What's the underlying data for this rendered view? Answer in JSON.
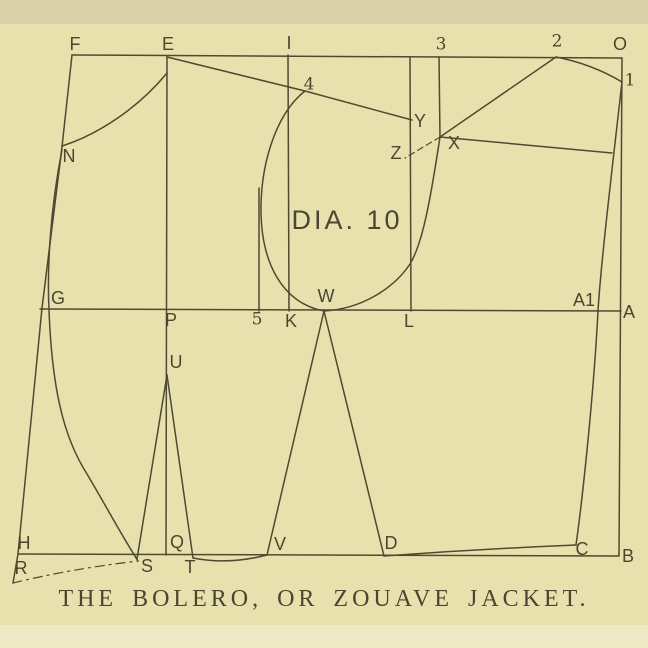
{
  "colors": {
    "paper": "#e9e1ad",
    "band_top": "#d8d1a9",
    "band_bottom": "#efe9c6",
    "ink": "#4e4932",
    "text": "#4a4631"
  },
  "caption": {
    "text": "THE BOLERO, OR ZOUAVE JACKET."
  },
  "diagram": {
    "title": "DIA. 10",
    "title_pos": {
      "x": 347,
      "y": 222
    },
    "points": [
      {
        "label": "F",
        "x": 75,
        "y": 45,
        "serif": false
      },
      {
        "label": "E",
        "x": 168,
        "y": 45,
        "serif": false
      },
      {
        "label": "I",
        "x": 289,
        "y": 44,
        "serif": false
      },
      {
        "label": "3",
        "x": 441,
        "y": 45,
        "serif": true
      },
      {
        "label": "2",
        "x": 557,
        "y": 42,
        "serif": true
      },
      {
        "label": "O",
        "x": 620,
        "y": 45,
        "serif": false
      },
      {
        "label": "1",
        "x": 630,
        "y": 81,
        "serif": true
      },
      {
        "label": "4",
        "x": 309,
        "y": 85,
        "serif": true
      },
      {
        "label": "N",
        "x": 69,
        "y": 157,
        "serif": false
      },
      {
        "label": "Y",
        "x": 420,
        "y": 122,
        "serif": false
      },
      {
        "label": "Z",
        "x": 396,
        "y": 154,
        "serif": false
      },
      {
        "label": "X",
        "x": 454,
        "y": 144,
        "serif": false
      },
      {
        "label": "G",
        "x": 58,
        "y": 299,
        "serif": false
      },
      {
        "label": "W",
        "x": 326,
        "y": 297,
        "serif": false
      },
      {
        "label": "A1",
        "x": 584,
        "y": 301,
        "serif": false
      },
      {
        "label": "P",
        "x": 171,
        "y": 321,
        "serif": false
      },
      {
        "label": "5",
        "x": 257,
        "y": 320,
        "serif": true
      },
      {
        "label": "K",
        "x": 291,
        "y": 322,
        "serif": false
      },
      {
        "label": "L",
        "x": 409,
        "y": 322,
        "serif": false
      },
      {
        "label": "A",
        "x": 629,
        "y": 313,
        "serif": false
      },
      {
        "label": "U",
        "x": 176,
        "y": 363,
        "serif": false
      },
      {
        "label": "H",
        "x": 24,
        "y": 544,
        "serif": false
      },
      {
        "label": "Q",
        "x": 177,
        "y": 543,
        "serif": false
      },
      {
        "label": "V",
        "x": 280,
        "y": 545,
        "serif": false
      },
      {
        "label": "D",
        "x": 391,
        "y": 544,
        "serif": false
      },
      {
        "label": "C",
        "x": 582,
        "y": 550,
        "serif": false
      },
      {
        "label": "B",
        "x": 628,
        "y": 557,
        "serif": false
      },
      {
        "label": "R",
        "x": 21,
        "y": 569,
        "serif": false
      },
      {
        "label": "S",
        "x": 147,
        "y": 567,
        "serif": false
      },
      {
        "label": "T",
        "x": 190,
        "y": 568,
        "serif": false
      }
    ]
  }
}
